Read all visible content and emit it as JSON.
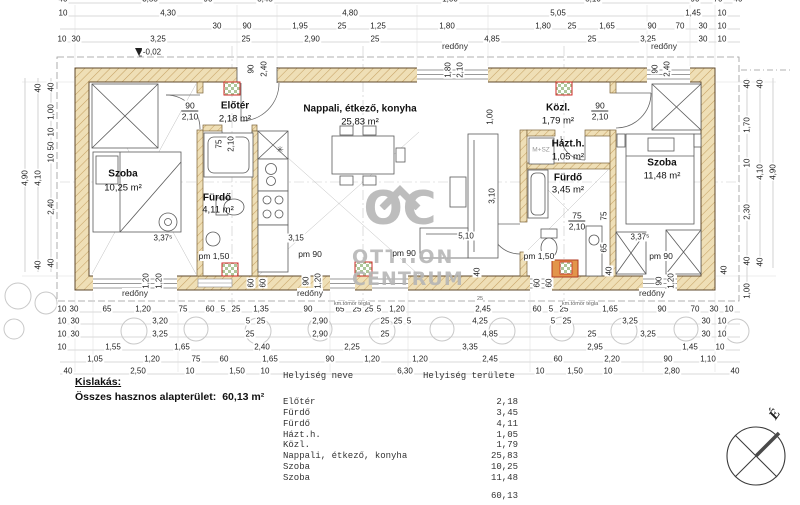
{
  "watermark": {
    "logo": "OC",
    "line1": "OTTHON",
    "line2": "CENTRUM"
  },
  "summary": {
    "heading": "Kislakás:",
    "label": "Összes hasznos alapterület:",
    "value": "60,13 m²"
  },
  "table": {
    "col_name": "Helyiség neve",
    "col_area": "Helyiség területe",
    "rows": [
      {
        "name": "Előtér",
        "area": "2,18"
      },
      {
        "name": "Fürdő",
        "area": "3,45"
      },
      {
        "name": "Fürdő",
        "area": "4,11"
      },
      {
        "name": "Házt.h.",
        "area": "1,05"
      },
      {
        "name": "Közl.",
        "area": "1,79"
      },
      {
        "name": "Nappali, étkező, konyha",
        "area": "25,83"
      },
      {
        "name": "Szoba",
        "area": "10,25"
      },
      {
        "name": "Szoba",
        "area": "11,48"
      }
    ],
    "total": "60,13"
  },
  "rooms": {
    "szoba_l": {
      "name": "Szoba",
      "area": "10,25 m²"
    },
    "eloter": {
      "name": "Előtér",
      "area": "2,18 m²"
    },
    "furdo_l": {
      "name": "Fürdő",
      "area": "4,11 m²"
    },
    "nappali": {
      "name": "Nappali, étkező, konyha",
      "area": "25,83 m²"
    },
    "kozl": {
      "name": "Közl.",
      "area": "1,79 m²"
    },
    "hazth": {
      "name": "Házt.h.",
      "area": "1,05 m²"
    },
    "furdo_r": {
      "name": "Fürdő",
      "area": "3,45 m²"
    },
    "szoba_r": {
      "name": "Szoba",
      "area": "11,48 m²"
    }
  },
  "ann": {
    "redony": "redőny",
    "level": "-0,02",
    "pm150": "pm 1,50",
    "pm90": "pm 90",
    "mpsz": "M+SZ",
    "brick": "km.tömör tégla",
    "north": "É",
    "star": "✳",
    "small25": "25"
  },
  "doors": {
    "w90": "90",
    "w75": "75",
    "h210": "2,10"
  },
  "dims": {
    "t0": [
      "40",
      "3,55",
      "90",
      "5,45",
      "1,00",
      "5,10",
      "90",
      "70",
      "40"
    ],
    "t1": [
      "10",
      "4,30",
      "4,80",
      "5,05",
      "1,45",
      "10"
    ],
    "t2": [
      "30",
      "90",
      "1,95",
      "25",
      "1,25",
      "1,80",
      "1,80",
      "25",
      "1,65",
      "90",
      "70",
      "30",
      "10"
    ],
    "t3": [
      "10",
      "30",
      "3,25",
      "25",
      "2,90",
      "25",
      "4,85",
      "25",
      "3,25",
      "30",
      "10"
    ],
    "lv": [
      "4,90",
      "40",
      "4,10",
      "40",
      "40",
      "1,00",
      "10",
      "50",
      "10",
      "2,40",
      "40"
    ],
    "rv": [
      "4,90",
      "40",
      "4,10",
      "40",
      "40",
      "1,70",
      "10",
      "2,30",
      "40",
      "1,00"
    ],
    "bA": [
      "10",
      "30",
      "65",
      "1,20",
      "75",
      "60",
      "5",
      "25",
      "1,35",
      "90",
      "65",
      "25",
      "25",
      "5",
      "1,20",
      "2,45",
      "60",
      "5",
      "25",
      "1,65",
      "90",
      "70",
      "30",
      "10"
    ],
    "bB": [
      "10",
      "30",
      "3,20",
      "5",
      "25",
      "2,90",
      "25",
      "25",
      "5",
      "4,25",
      "5",
      "25",
      "3,25",
      "30",
      "10"
    ],
    "bC": [
      "10",
      "30",
      "3,25",
      "25",
      "2,90",
      "25",
      "4,85",
      "25",
      "3,25",
      "30",
      "10"
    ],
    "bD": [
      "10",
      "1,55",
      "1,65",
      "2,40",
      "2,25",
      "3,35",
      "2,95",
      "1,45",
      "10"
    ],
    "bE": [
      "1,05",
      "1,20",
      "75",
      "60",
      "1,65",
      "90",
      "1,20",
      "1,20",
      "2,45",
      "60",
      "2,20",
      "90",
      "1,10"
    ],
    "bF": [
      "40",
      "2,50",
      "10",
      "1,50",
      "10",
      "6,30",
      "10",
      "1,50",
      "10",
      "2,80",
      "40"
    ],
    "rot": [
      "90",
      "2,40",
      "1,80",
      "2,10",
      "90",
      "2,40",
      "1,20",
      "1,20",
      "60",
      "60",
      "90",
      "1,20",
      "40",
      "60",
      "60",
      "40",
      "90",
      "1,20",
      "40",
      "3,10",
      "1,00",
      "75",
      "65",
      "75",
      "2,10"
    ],
    "inner": [
      "3,37⁵",
      "3,15",
      "5,10",
      "3,37⁵"
    ]
  }
}
